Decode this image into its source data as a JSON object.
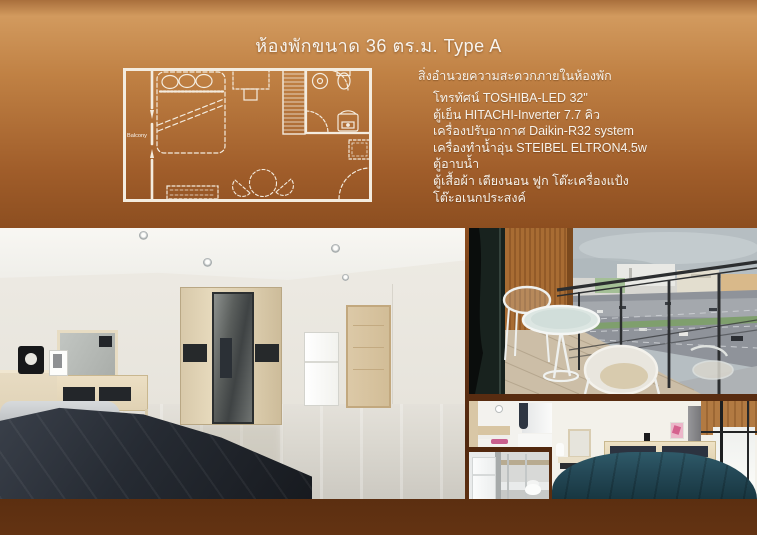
{
  "page": {
    "title": "ห้องพักขนาด 36 ตร.ม. Type A"
  },
  "facilities": {
    "heading": "สิ่งอำนวยความสะดวกภายในห้องพัก",
    "items": [
      "โทรทัศน์ TOSHIBA-LED 32\"",
      "ตู้เย็น HITACHI-Inverter 7.7 คิว",
      "เครื่องปรับอากาศ Daikin-R32 system",
      "เครื่องทำน้ำอุ่น STEIBEL ELTRON4.5w",
      "ตู้อาบน้ำ",
      "ตู้เสื้อผ้า เตียงนอน ฟูก โต๊ะเครื่องแป้ง",
      "โต๊ะอเนกประสงค์"
    ]
  },
  "floor_plan": {
    "balcony_label": "Balcony"
  },
  "colors": {
    "background_top": "#d29a5e",
    "background_bottom": "#633312",
    "text": "#f8f4ee",
    "plan_lines": "#f4ecdf",
    "teal_bed": "#244856",
    "wood_slats": "#a86c33",
    "dark_bed": "#262b33"
  }
}
